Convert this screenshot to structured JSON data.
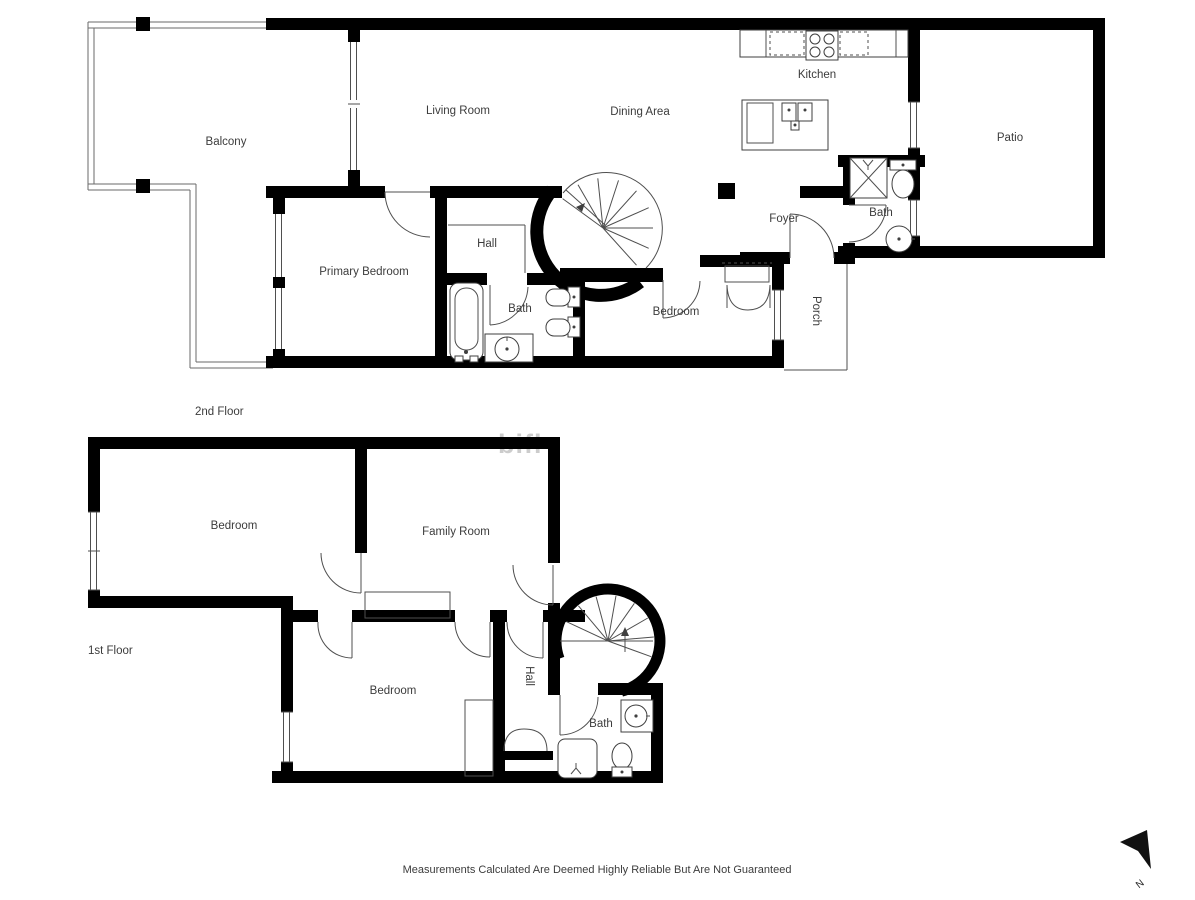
{
  "colors": {
    "background": "#ffffff",
    "wall": "#000000",
    "line": "#4f4f4f",
    "text": "#3c3c3c",
    "watermark": "#c4c4c4"
  },
  "floor2": {
    "title": "2nd Floor",
    "rooms": {
      "balcony": "Balcony",
      "living_room": "Living Room",
      "dining_area": "Dining Area",
      "kitchen": "Kitchen",
      "patio": "Patio",
      "primary_bedroom": "Primary Bedroom",
      "hall": "Hall",
      "bath": "Bath",
      "bedroom": "Bedroom",
      "foyer": "Foyer",
      "bath_upper": "Bath",
      "porch": "Porch"
    }
  },
  "floor1": {
    "title": "1st Floor",
    "rooms": {
      "bedroom": "Bedroom",
      "family_room": "Family Room",
      "bedroom_lower": "Bedroom",
      "hall": "Hall",
      "bath": "Bath"
    }
  },
  "footer": {
    "disclaimer": "Measurements Calculated Are Deemed Highly Reliable But Are Not Guaranteed"
  },
  "compass": {
    "north": "N"
  },
  "watermark": {
    "text": "bifl"
  }
}
